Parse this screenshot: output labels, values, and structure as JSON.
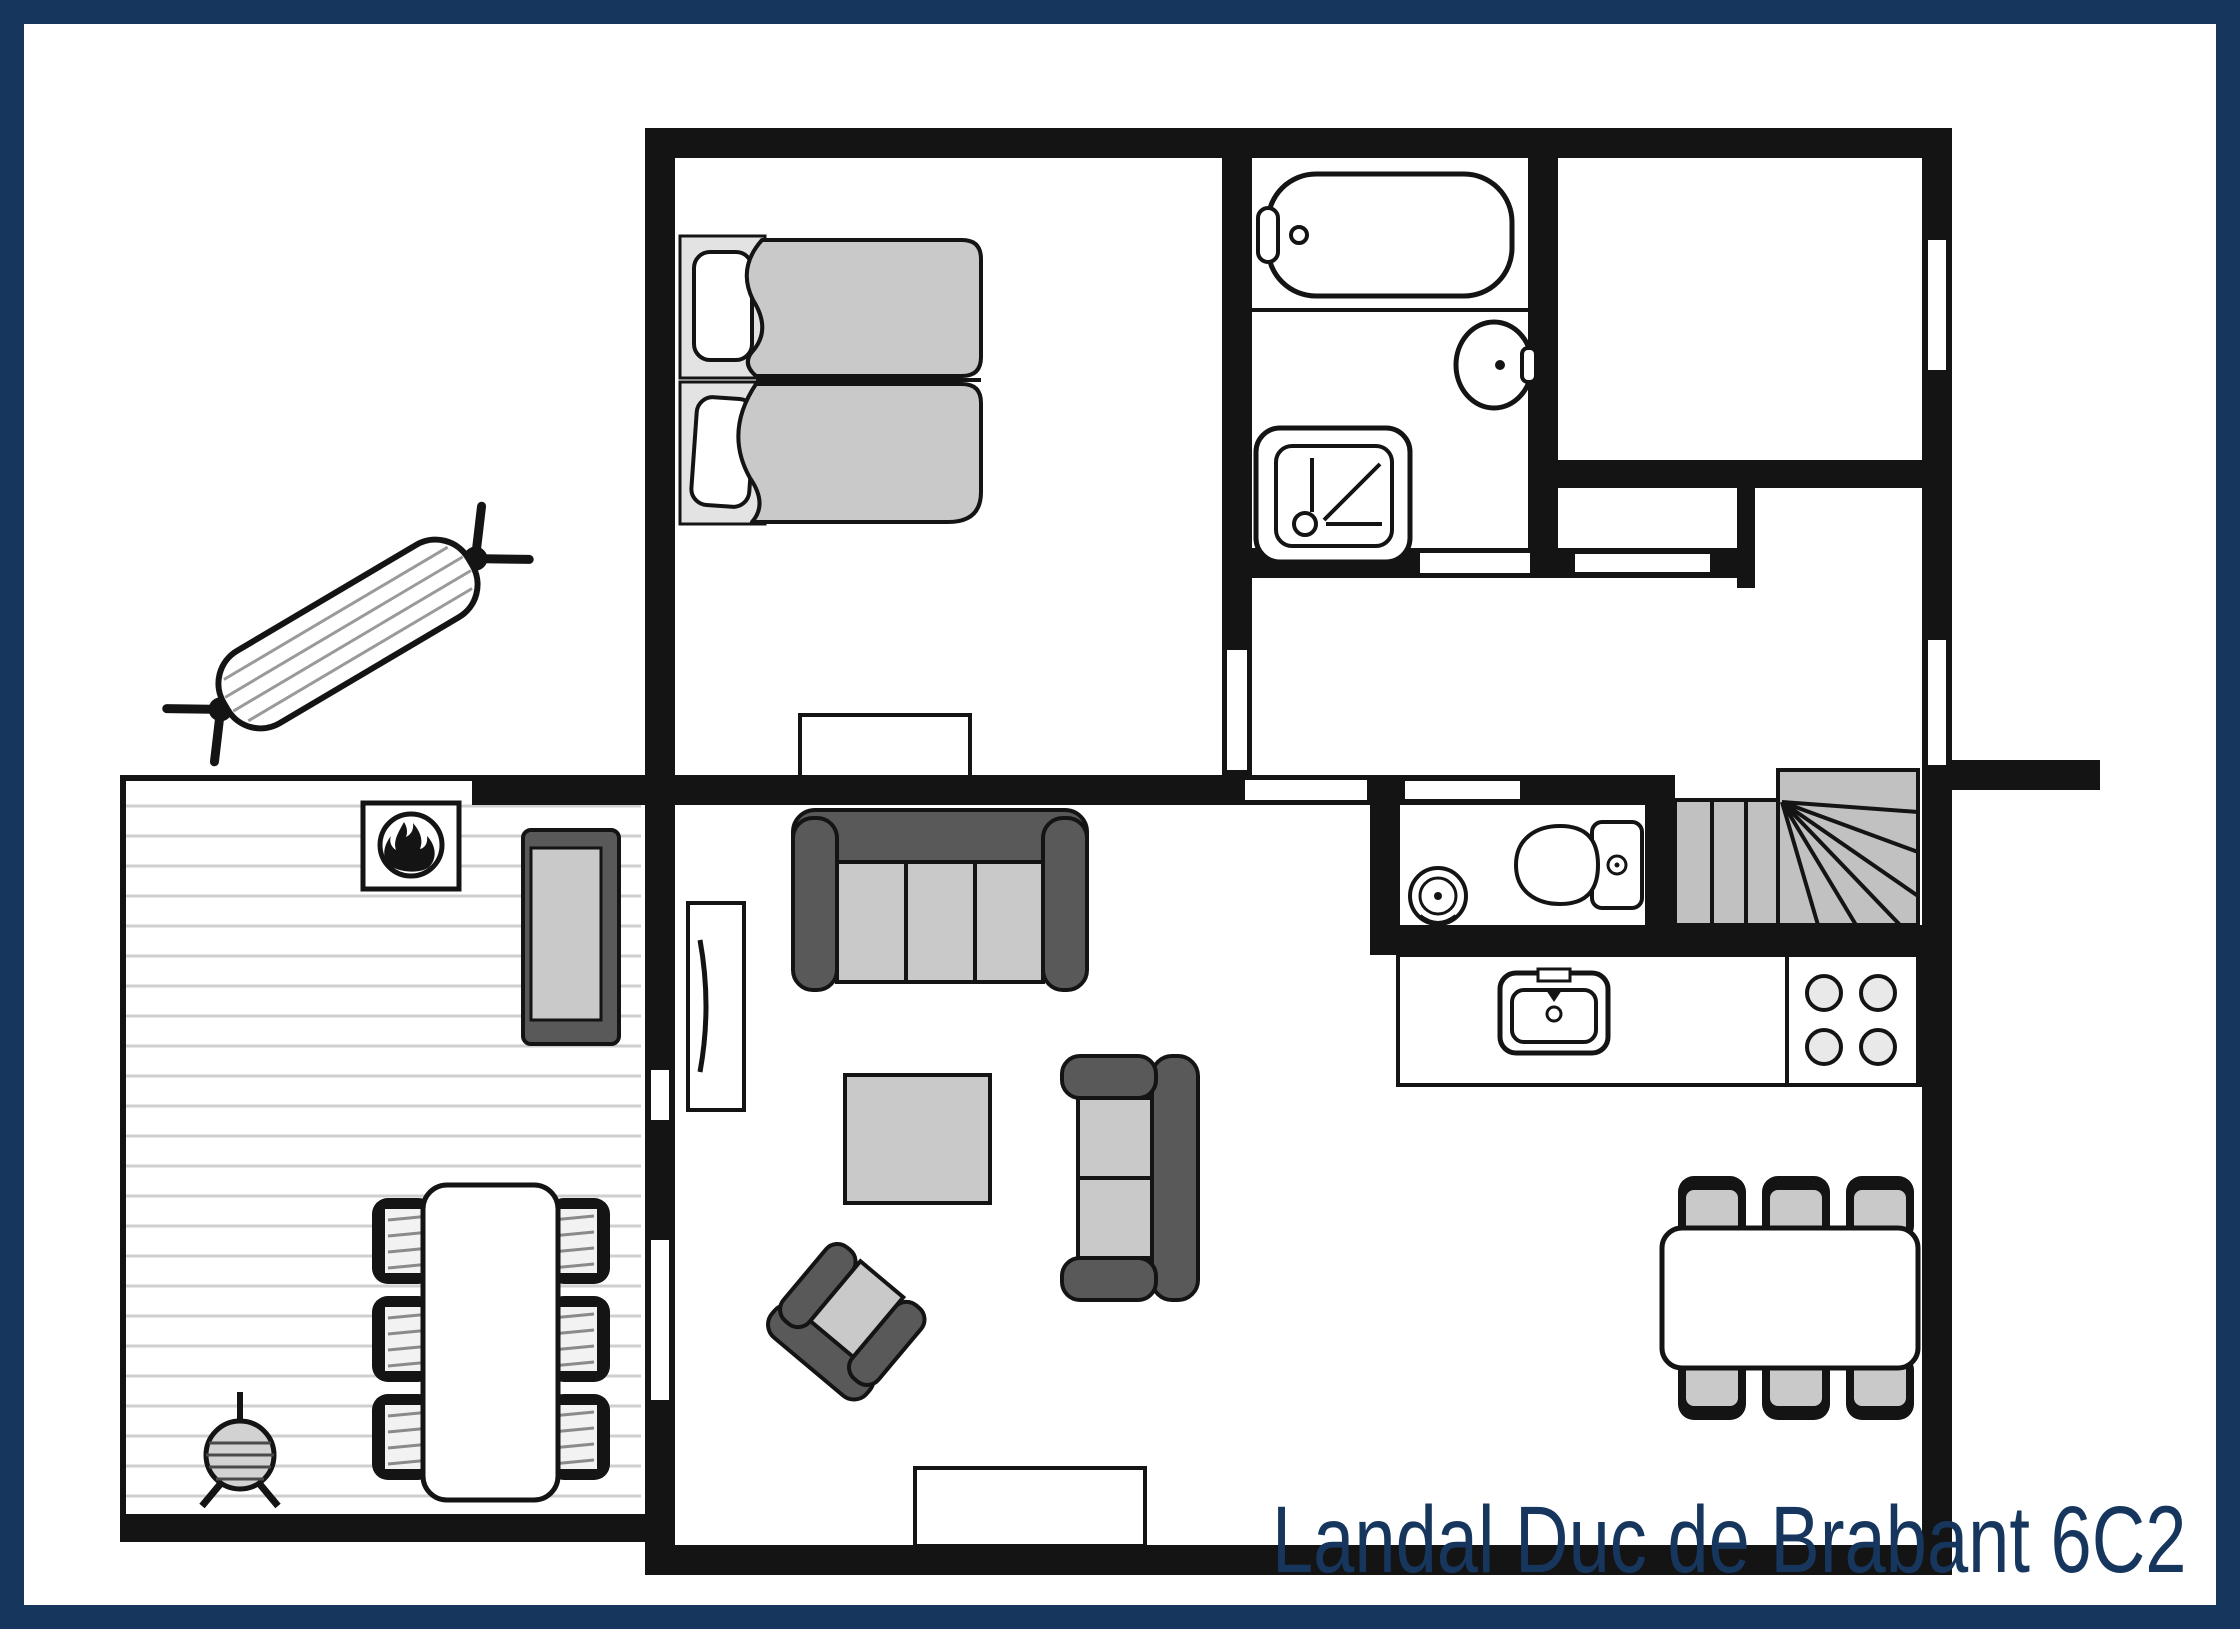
{
  "title": {
    "label": "Landal Duc de Brabant 6C2"
  },
  "colors": {
    "frame_navy": "#17365D",
    "wall_black": "#141414",
    "furniture_light_gray": "#c9c9c9",
    "furniture_dark_gray": "#595959",
    "stair_gray": "#c1c1c1",
    "deck_stripe_gray": "#cfcfcf",
    "burner_gray": "#e9e9e9",
    "paper_white": "#ffffff"
  },
  "plan_icons": [
    "double-bed",
    "bathtub",
    "washbasin",
    "shower",
    "toilet",
    "corner-sink",
    "staircase-winder",
    "kitchen-sink",
    "stove-4-burners",
    "sofa-3-seat",
    "sofa-2-seat",
    "armchair",
    "coffee-table",
    "tv-cabinet",
    "sideboard",
    "dining-table-6-chairs",
    "terrace-table-6-chairs",
    "garden-bench",
    "fireplace",
    "barbecue",
    "hammock",
    "terrace-deck"
  ]
}
